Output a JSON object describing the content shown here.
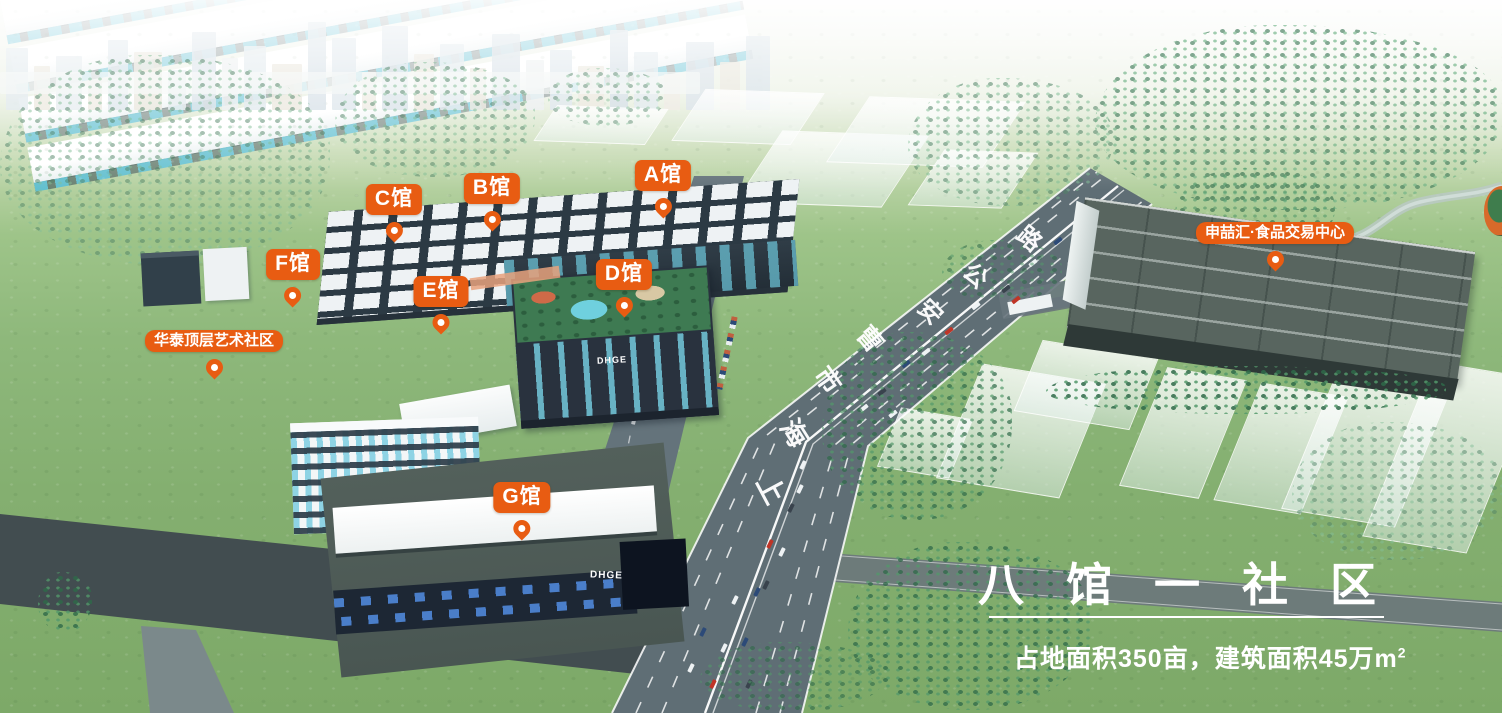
{
  "scene": {
    "description": "八馆一社区 产业园区鸟瞰图"
  },
  "theme": {
    "accent_orange": "#E85C12",
    "grass_green": "#84AF70",
    "road_grey": "#5F6E75",
    "dark_roof": "#2C3A44",
    "text_white": "#FFFFFF"
  },
  "markers": [
    {
      "id": "hall-c",
      "label": "C馆"
    },
    {
      "id": "hall-b",
      "label": "B馆"
    },
    {
      "id": "hall-a",
      "label": "A馆"
    },
    {
      "id": "hall-f",
      "label": "F馆"
    },
    {
      "id": "hall-e",
      "label": "E馆"
    },
    {
      "id": "hall-d",
      "label": "D馆"
    },
    {
      "id": "hall-g",
      "label": "G馆"
    },
    {
      "id": "huatai",
      "label": "华泰顶层艺术社区"
    },
    {
      "id": "shenzhehui",
      "label": "申喆汇·食品交易中心"
    }
  ],
  "road_name": {
    "full": "上海市曹安公路",
    "chars": [
      "上",
      "海",
      "市",
      "曹",
      "安",
      "公",
      "路"
    ]
  },
  "caption": {
    "title": "八馆一社区",
    "area_text": "占地面积350亩，建筑面积45万m",
    "area_sup": "2"
  },
  "logos": {
    "dhge": "DHGE"
  }
}
